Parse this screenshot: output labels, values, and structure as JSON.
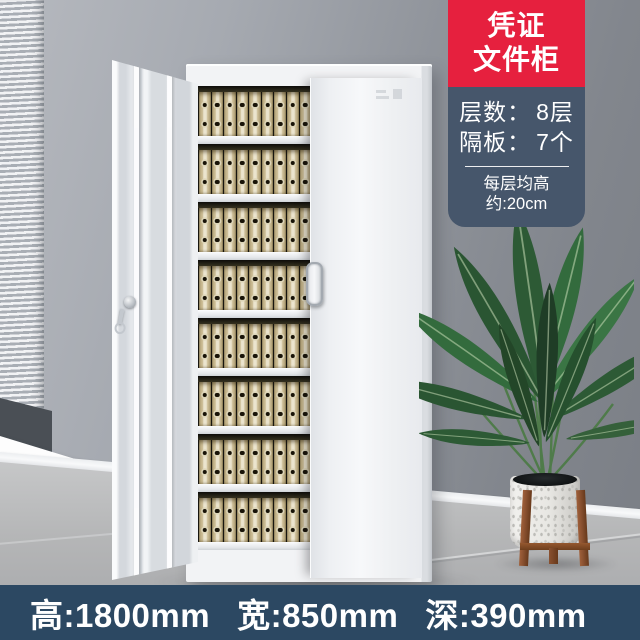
{
  "product_badge": {
    "title_line1": "凭证",
    "title_line2": "文件柜",
    "accent_red": "#e6203e",
    "panel_bg": "#46566b",
    "specs": [
      {
        "label": "层数：",
        "value": "8层"
      },
      {
        "label": "隔板：",
        "value": "7个"
      }
    ],
    "note": "每层均高约:20cm"
  },
  "dimension_bar": {
    "bg": "#2c4862",
    "items": [
      "高:1800mm",
      "宽:850mm",
      "深:390mm"
    ]
  },
  "cabinet": {
    "levels": 8,
    "binders_per_level": 9,
    "binder_color": "#ccbd96",
    "body_color": "#f2f3f5"
  },
  "scene": {
    "wall_color": "#90949b",
    "floor_color": "#b5b6b7",
    "plant_green": "#2d5a35",
    "pot_color": "#e8e7e3",
    "stand_wood": "#8a5130"
  }
}
